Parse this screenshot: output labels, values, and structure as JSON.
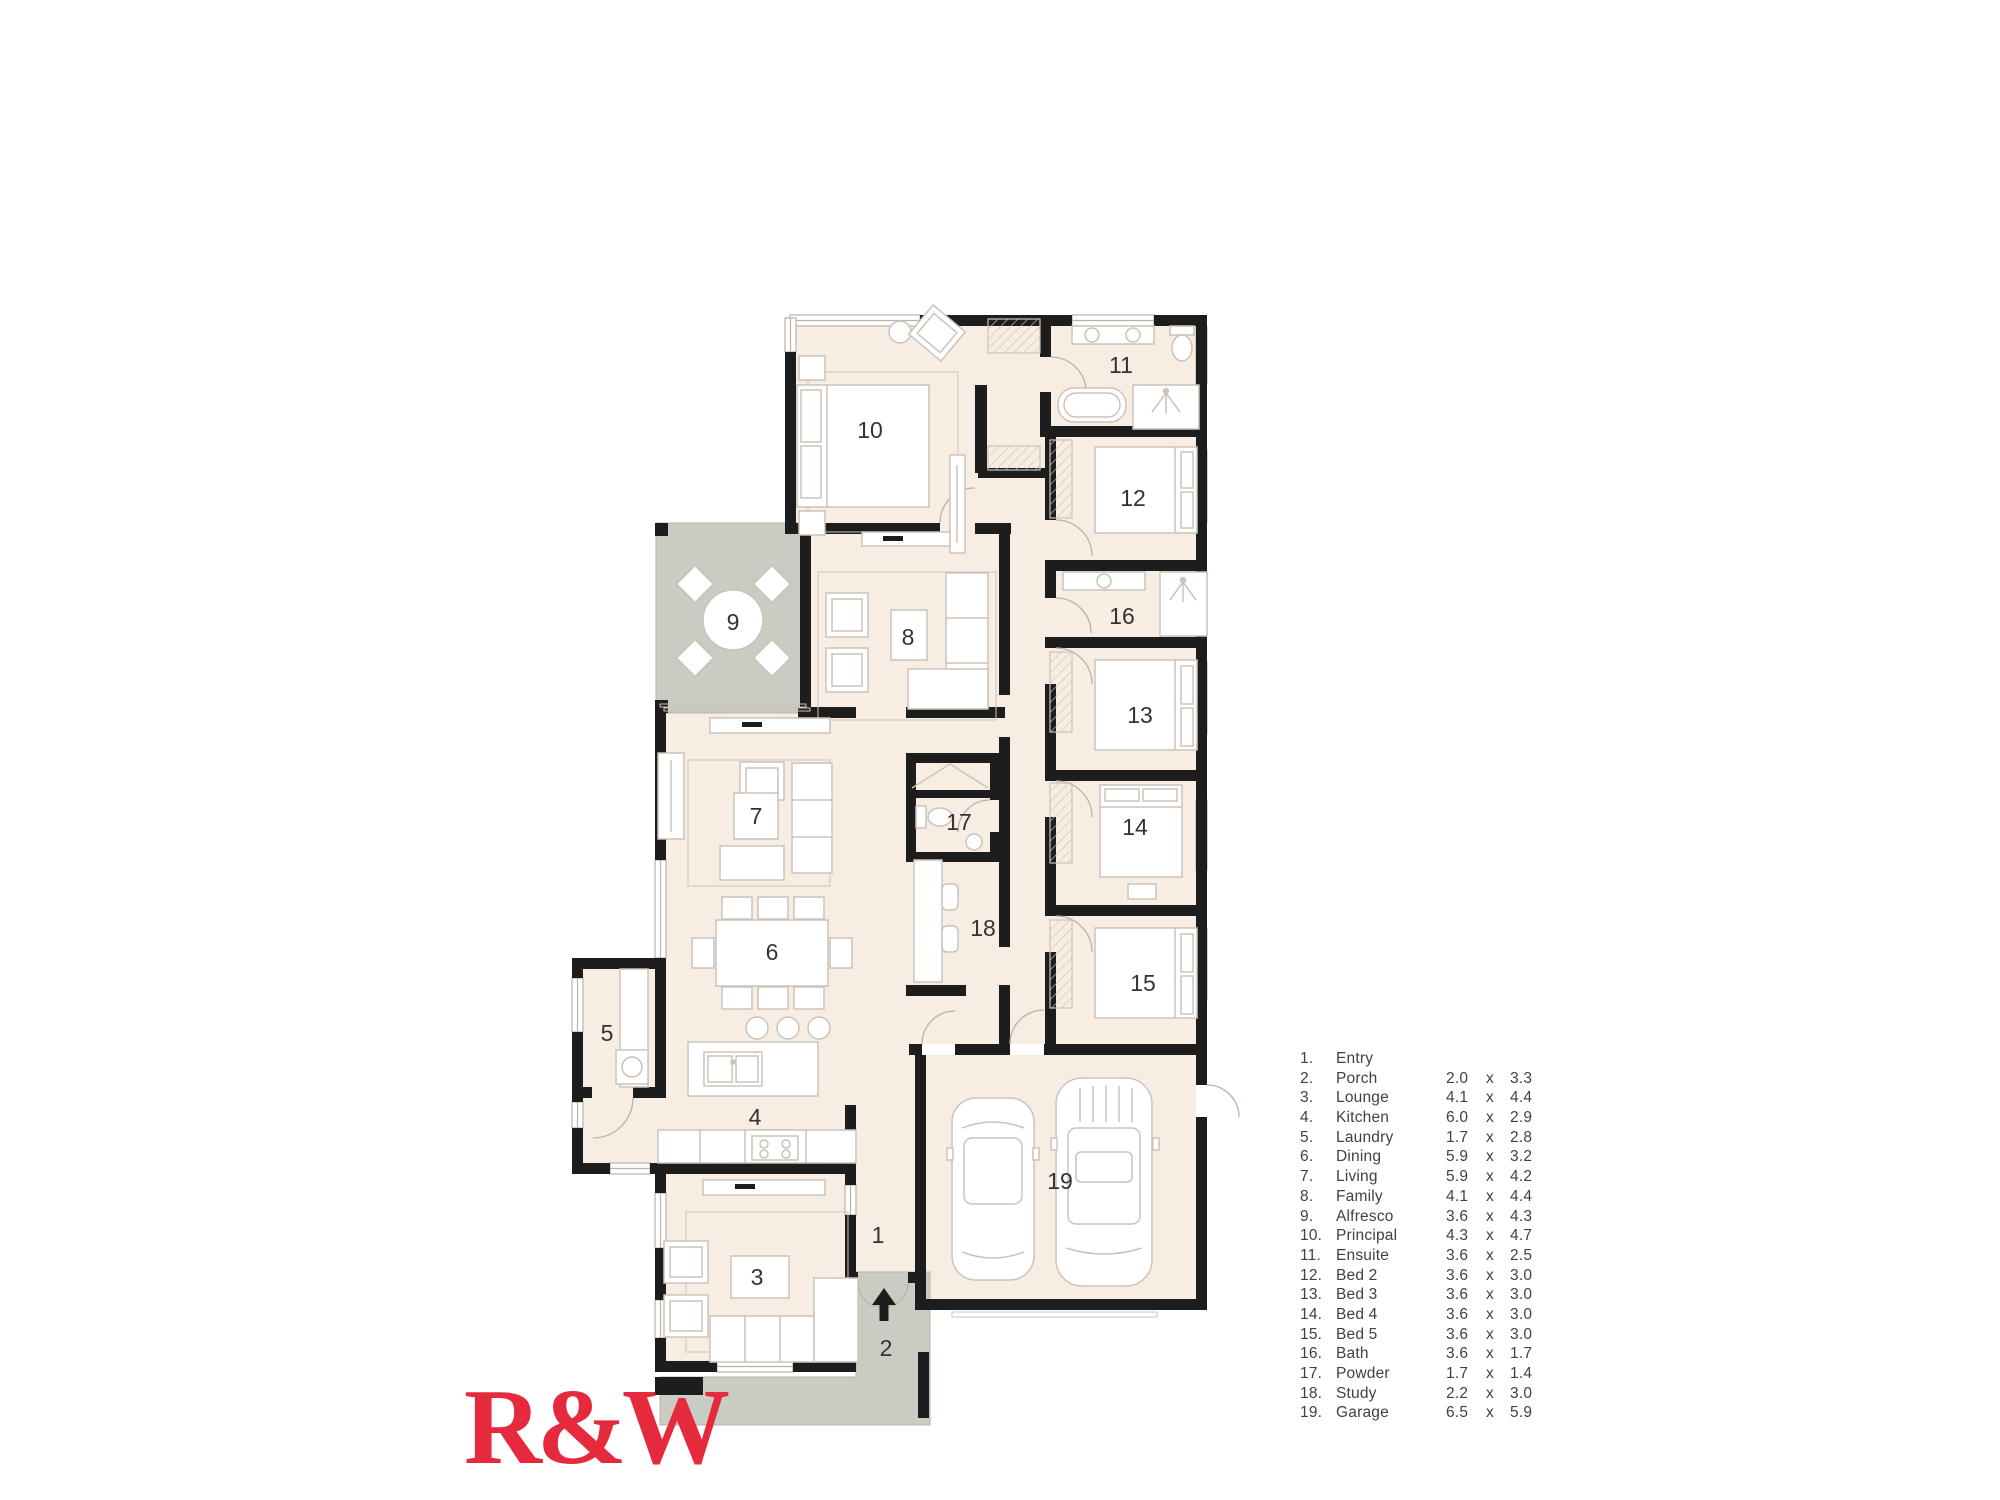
{
  "logo": {
    "text": "R&W"
  },
  "colors": {
    "floor": "#f8ede3",
    "outdoor": "#c9ccc2",
    "wall": "#1d1d1d",
    "furniture_line": "#cbc3ba",
    "window_line": "#b9b2a9",
    "label_text": "#333333",
    "legend_text": "#414141",
    "logo_red": "#e52a3d",
    "background": "#ffffff"
  },
  "plan": {
    "room_labels": [
      {
        "num": "1",
        "x": 878,
        "y": 1243
      },
      {
        "num": "2",
        "x": 886,
        "y": 1356
      },
      {
        "num": "3",
        "x": 757,
        "y": 1285
      },
      {
        "num": "4",
        "x": 755,
        "y": 1125
      },
      {
        "num": "5",
        "x": 607,
        "y": 1041
      },
      {
        "num": "6",
        "x": 772,
        "y": 960
      },
      {
        "num": "7",
        "x": 756,
        "y": 824
      },
      {
        "num": "8",
        "x": 908,
        "y": 645
      },
      {
        "num": "9",
        "x": 733,
        "y": 630
      },
      {
        "num": "10",
        "x": 870,
        "y": 438
      },
      {
        "num": "11",
        "x": 1121,
        "y": 373
      },
      {
        "num": "12",
        "x": 1133,
        "y": 506
      },
      {
        "num": "13",
        "x": 1140,
        "y": 723
      },
      {
        "num": "14",
        "x": 1135,
        "y": 835
      },
      {
        "num": "15",
        "x": 1143,
        "y": 991
      },
      {
        "num": "16",
        "x": 1122,
        "y": 624
      },
      {
        "num": "17",
        "x": 959,
        "y": 830
      },
      {
        "num": "18",
        "x": 983,
        "y": 936
      },
      {
        "num": "19",
        "x": 1060,
        "y": 1189
      }
    ]
  },
  "legend": {
    "items": [
      {
        "num": "1.",
        "name": "Entry",
        "w": "",
        "sep": "",
        "h": ""
      },
      {
        "num": "2.",
        "name": "Porch",
        "w": "2.0",
        "sep": "x",
        "h": "3.3"
      },
      {
        "num": "3.",
        "name": "Lounge",
        "w": "4.1",
        "sep": "x",
        "h": "4.4"
      },
      {
        "num": "4.",
        "name": "Kitchen",
        "w": "6.0",
        "sep": "x",
        "h": "2.9"
      },
      {
        "num": "5.",
        "name": "Laundry",
        "w": "1.7",
        "sep": "x",
        "h": "2.8"
      },
      {
        "num": "6.",
        "name": "Dining",
        "w": "5.9",
        "sep": "x",
        "h": "3.2"
      },
      {
        "num": "7.",
        "name": "Living",
        "w": "5.9",
        "sep": "x",
        "h": "4.2"
      },
      {
        "num": "8.",
        "name": "Family",
        "w": "4.1",
        "sep": "x",
        "h": "4.4"
      },
      {
        "num": "9.",
        "name": "Alfresco",
        "w": "3.6",
        "sep": "x",
        "h": "4.3"
      },
      {
        "num": "10.",
        "name": "Principal",
        "w": "4.3",
        "sep": "x",
        "h": "4.7"
      },
      {
        "num": "11.",
        "name": "Ensuite",
        "w": "3.6",
        "sep": "x",
        "h": "2.5"
      },
      {
        "num": "12.",
        "name": "Bed 2",
        "w": "3.6",
        "sep": "x",
        "h": "3.0"
      },
      {
        "num": "13.",
        "name": "Bed 3",
        "w": "3.6",
        "sep": "x",
        "h": "3.0"
      },
      {
        "num": "14.",
        "name": "Bed 4",
        "w": "3.6",
        "sep": "x",
        "h": "3.0"
      },
      {
        "num": "15.",
        "name": "Bed 5",
        "w": "3.6",
        "sep": "x",
        "h": "3.0"
      },
      {
        "num": "16.",
        "name": "Bath",
        "w": "3.6",
        "sep": "x",
        "h": "1.7"
      },
      {
        "num": "17.",
        "name": "Powder",
        "w": "1.7",
        "sep": "x",
        "h": "1.4"
      },
      {
        "num": "18.",
        "name": "Study",
        "w": "2.2",
        "sep": "x",
        "h": "3.0"
      },
      {
        "num": "19.",
        "name": "Garage",
        "w": "6.5",
        "sep": "x",
        "h": "5.9"
      }
    ]
  }
}
